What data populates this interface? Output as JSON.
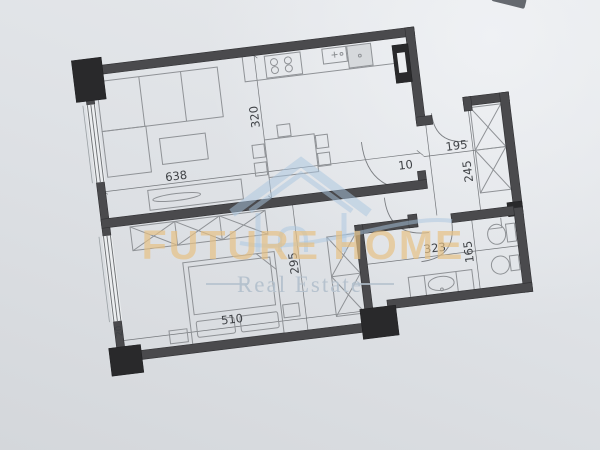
{
  "watermark": {
    "brand": "FUTURE HOME",
    "tagline": "Real Estate",
    "brand_color": "#e7c183",
    "tagline_color": "#b4c1cd",
    "logo": "house-icon"
  },
  "floor_plan": {
    "rotation_deg": -7,
    "colors": {
      "paper": "#dfe2e6",
      "wall": "#4a4a4d",
      "column": "#29292b",
      "furniture_line": "#8f9296",
      "dimension_text": "#3f4246"
    },
    "dimensions": {
      "living_width": "638",
      "living_depth": "320",
      "entry_stub": "10",
      "hall_width": "195",
      "hall_depth": "245",
      "bedroom_width": "510",
      "bedroom_depth": "295",
      "left_wall": "20",
      "bath_width": "323",
      "bath_depth": "165"
    }
  }
}
